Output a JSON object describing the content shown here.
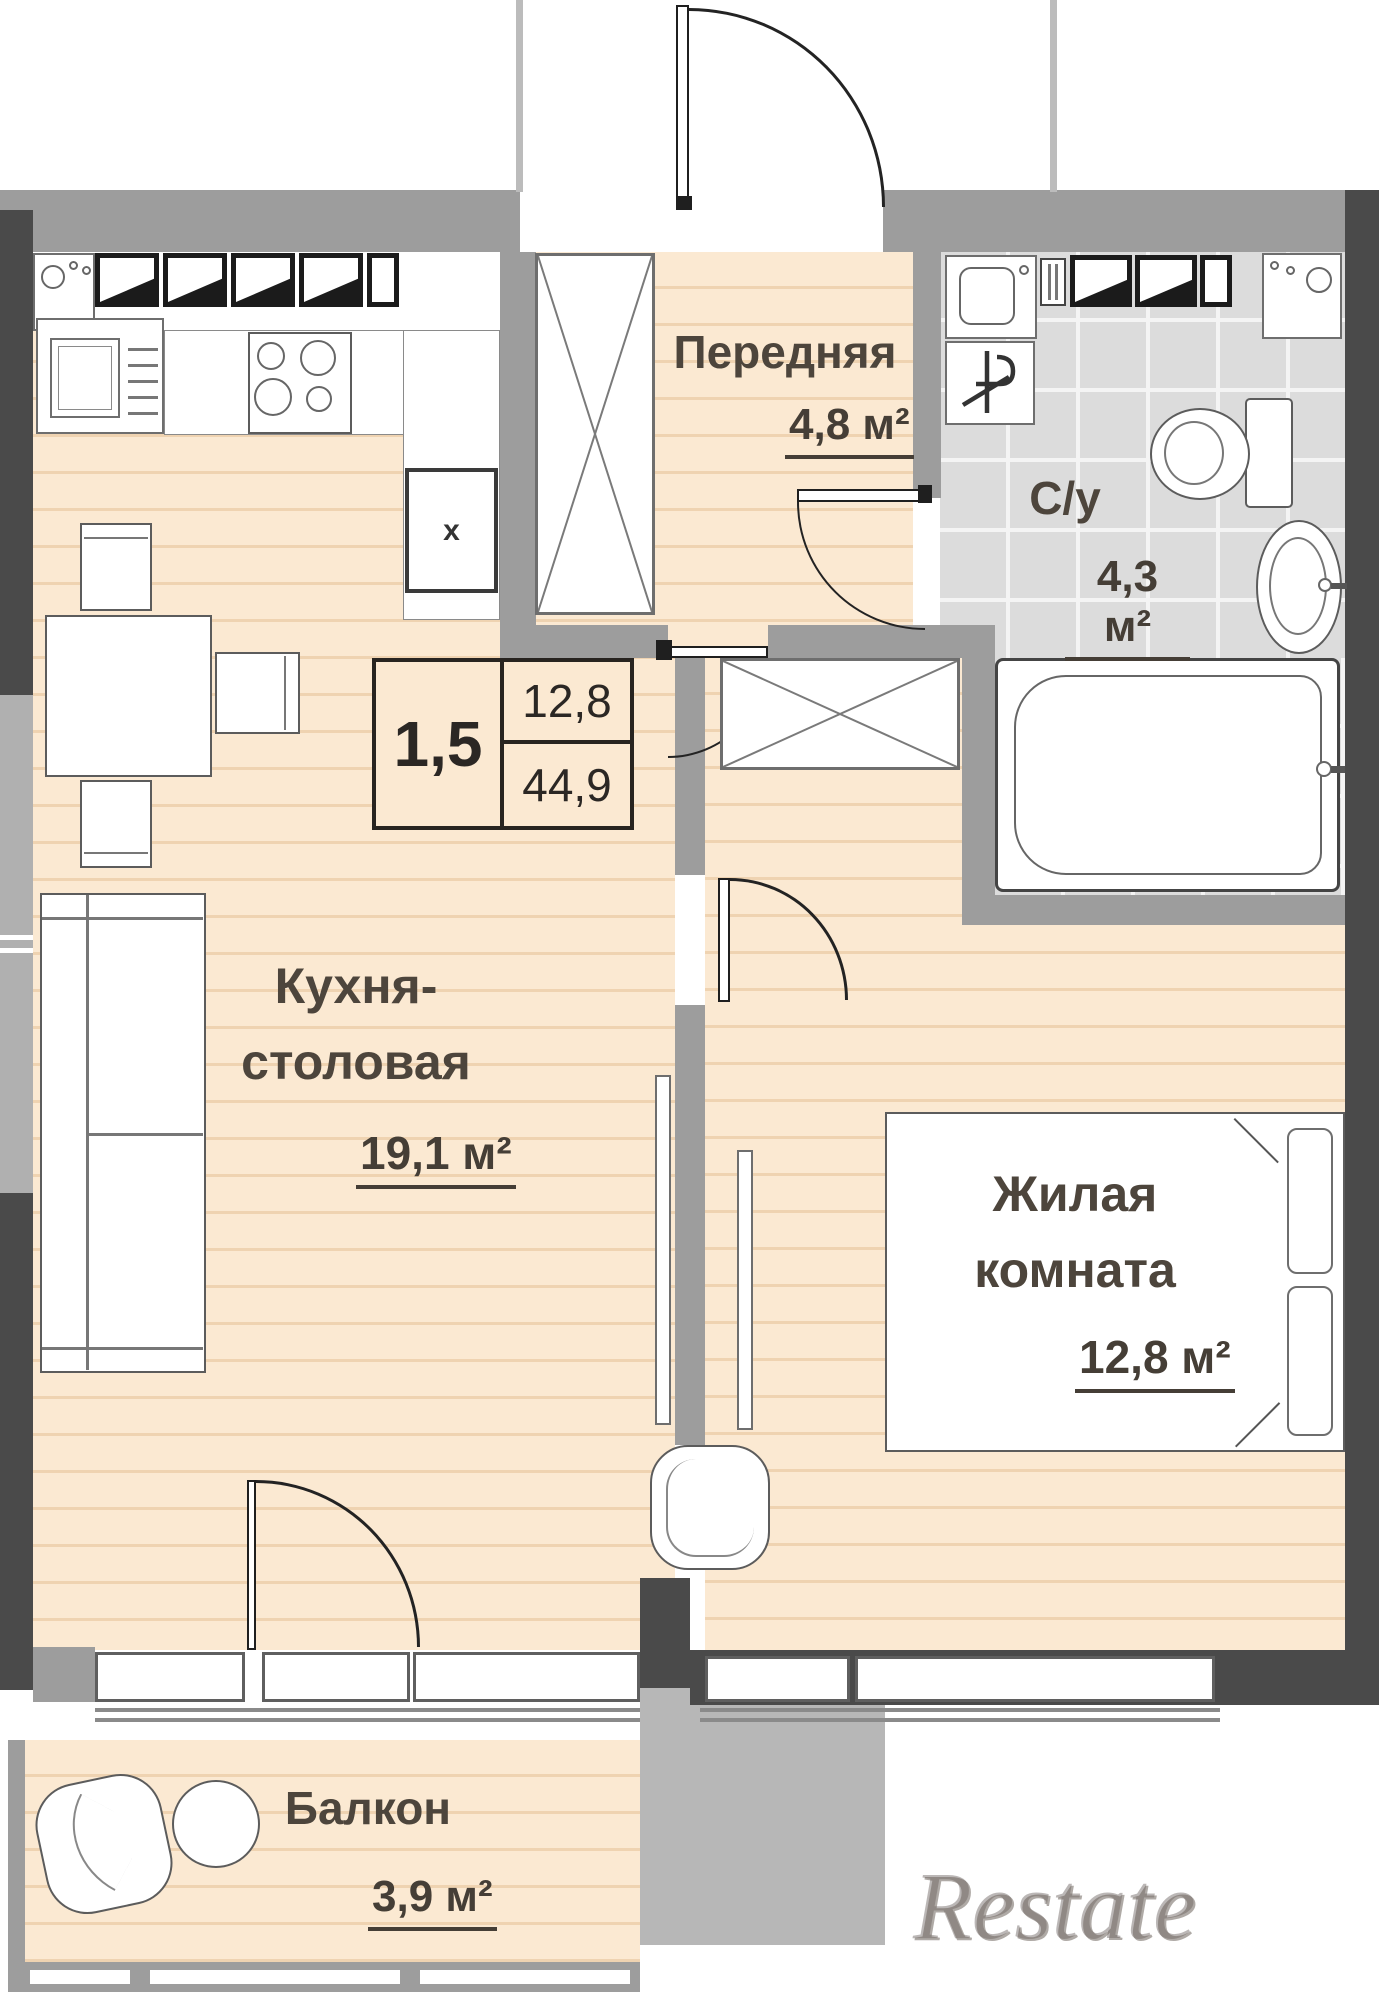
{
  "info_box": {
    "room_count": "1,5",
    "living_area": "12,8",
    "total_area": "44,9"
  },
  "rooms": {
    "hallway": {
      "name": "Передняя",
      "area": "4,8 м²"
    },
    "bathroom": {
      "name": "С/у",
      "area": "4,3 м²"
    },
    "kitchen": {
      "name_line1": "Кухня-",
      "name_line2": "столовая",
      "area": "19,1 м²"
    },
    "living": {
      "name_line1": "Жилая",
      "name_line2": "комната",
      "area": "12,8 м²"
    },
    "balcony": {
      "name": "Балкон",
      "area": "3,9 м²"
    }
  },
  "markers": {
    "vent": "x"
  },
  "watermark": "Restate",
  "colors": {
    "floor": "#fbe9d2",
    "wall_dark": "#4a4a4a",
    "wall_light": "#9d9d9d",
    "tile": "#dcdcdc",
    "label": "#4d453c"
  }
}
